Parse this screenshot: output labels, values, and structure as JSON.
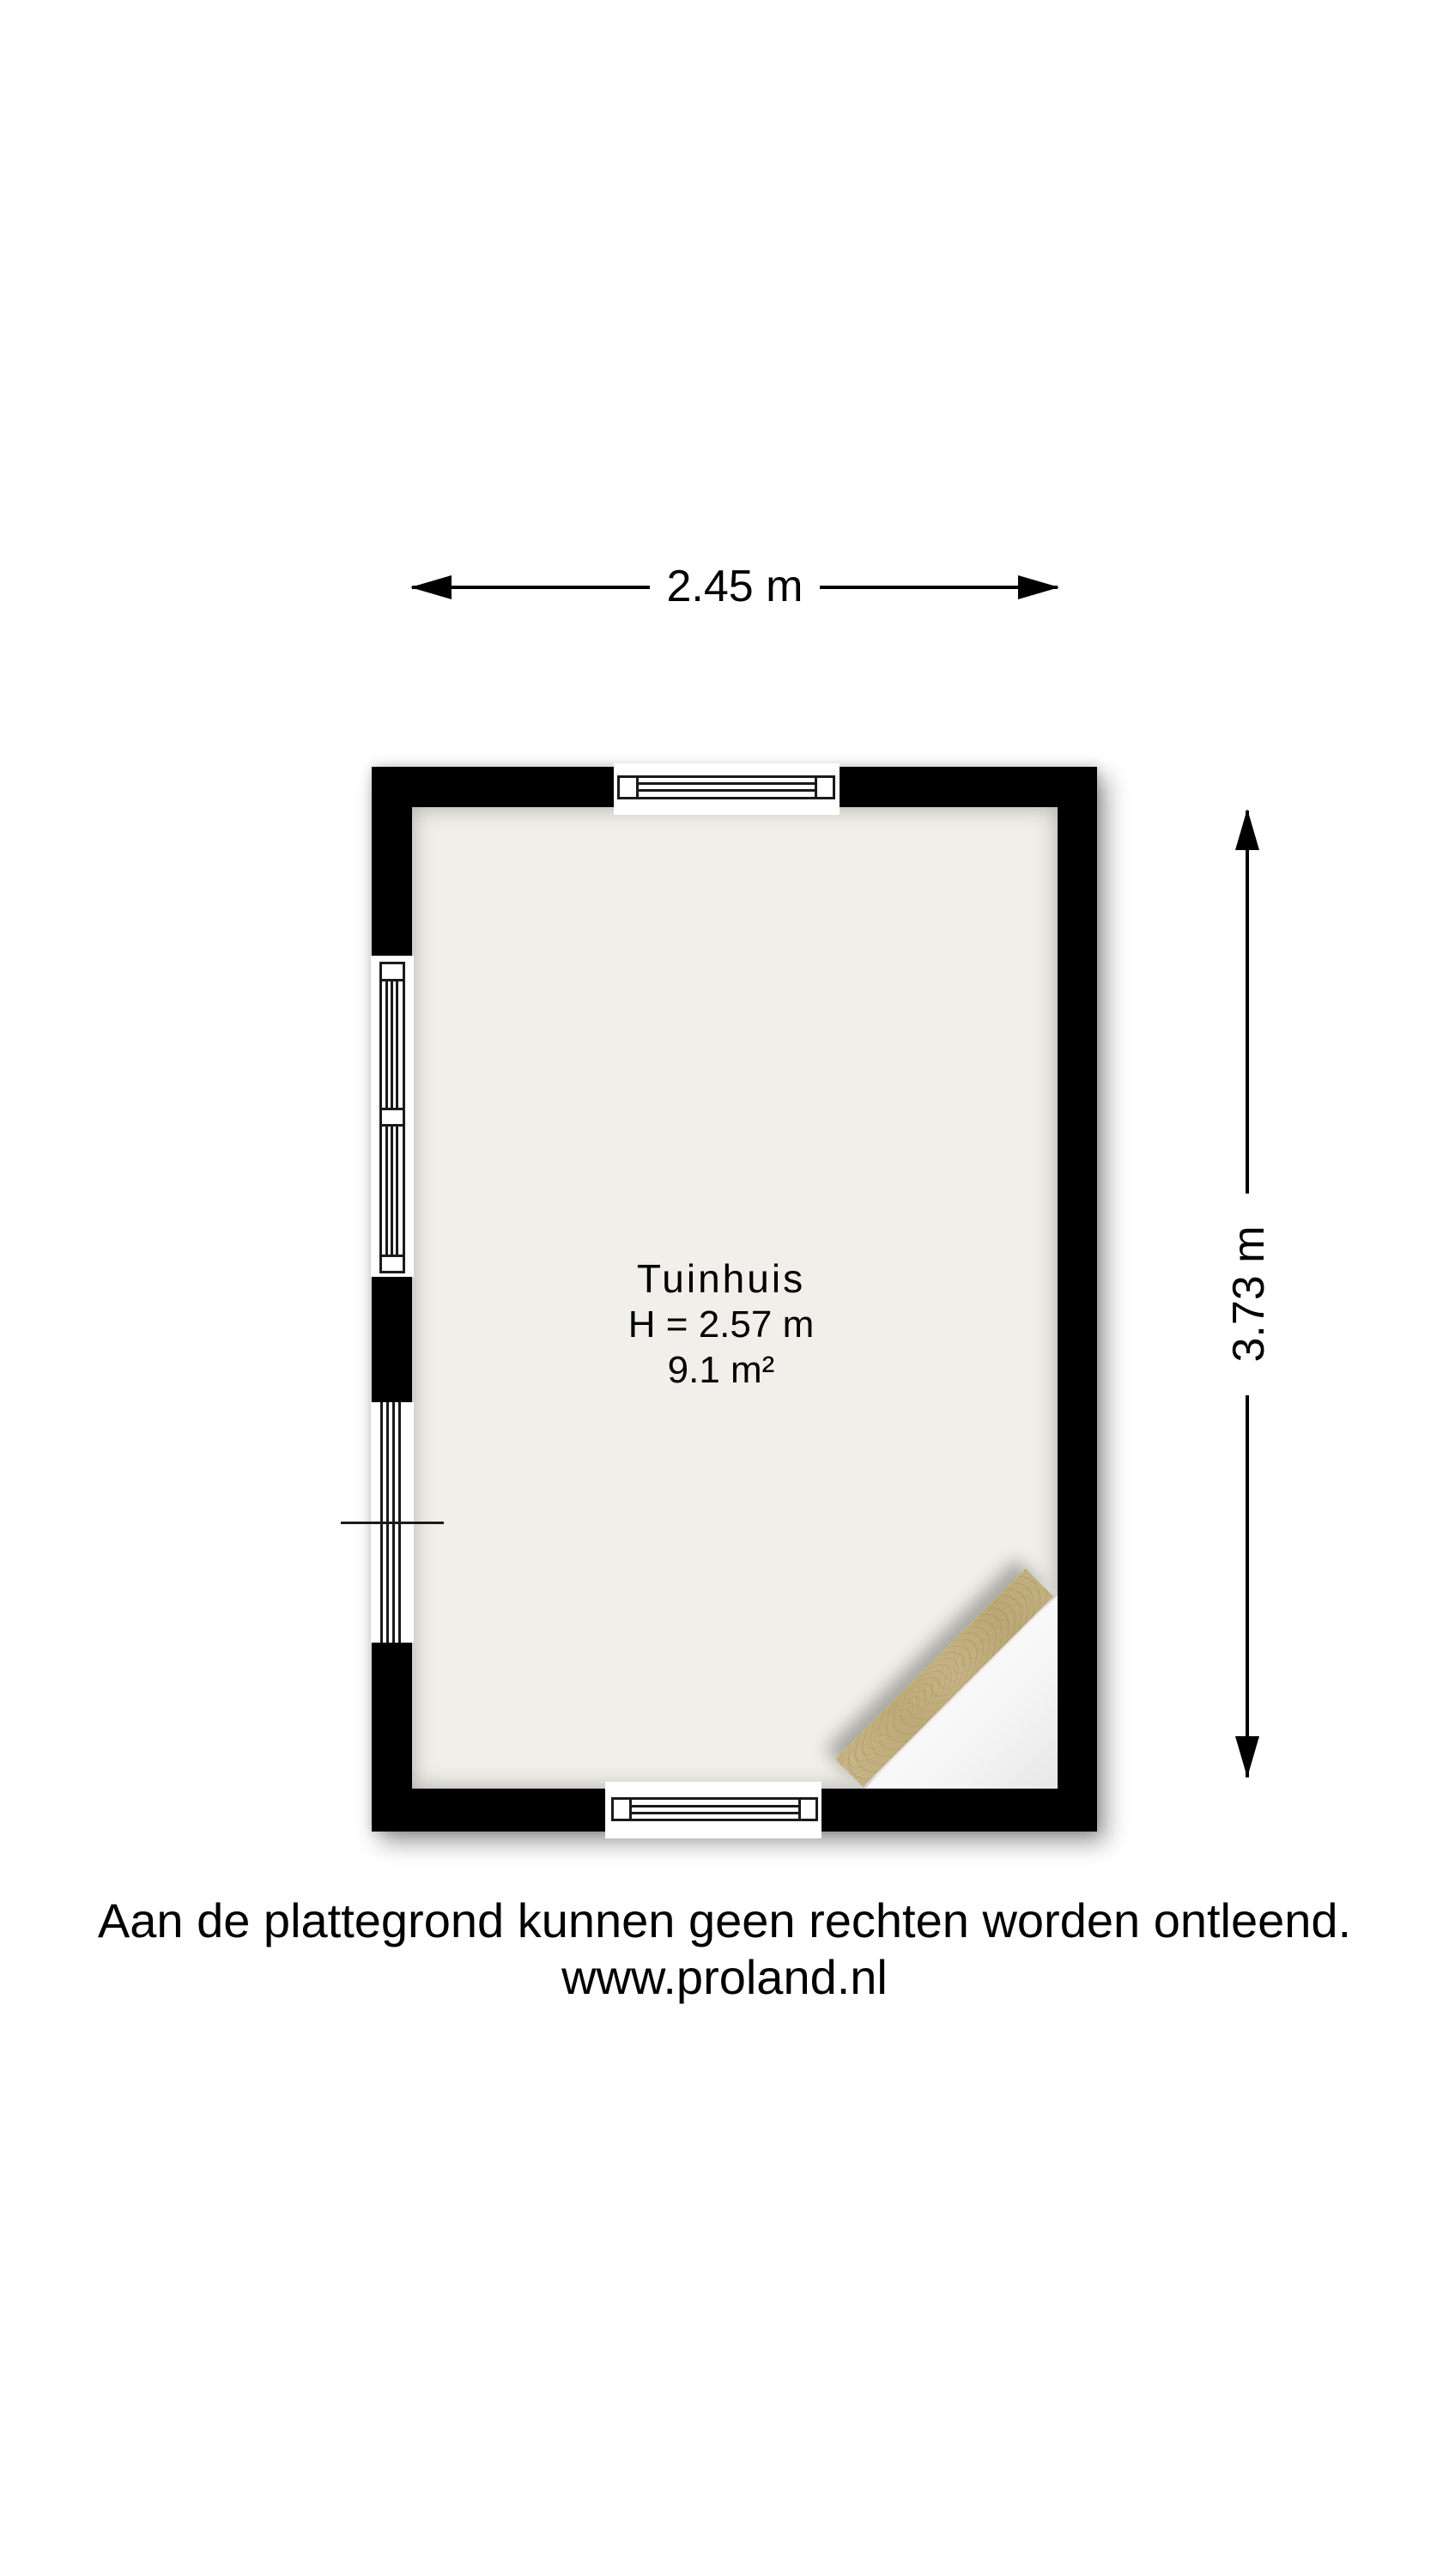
{
  "plan": {
    "room": {
      "name": "Tuinhuis",
      "ceiling_height": "H = 2.57 m",
      "area": "9.1 m²"
    },
    "dimensions": {
      "width": "2.45 m",
      "depth": "3.73 m"
    },
    "colors": {
      "wall": "#000000",
      "floor": "#f0efe9",
      "line": "#1a1a1a",
      "plank": "#c2b07f",
      "corner": "#ffffff"
    }
  },
  "footer": {
    "disclaimer": "Aan de plattegrond kunnen geen rechten worden ontleend.",
    "website": "www.proland.nl"
  }
}
